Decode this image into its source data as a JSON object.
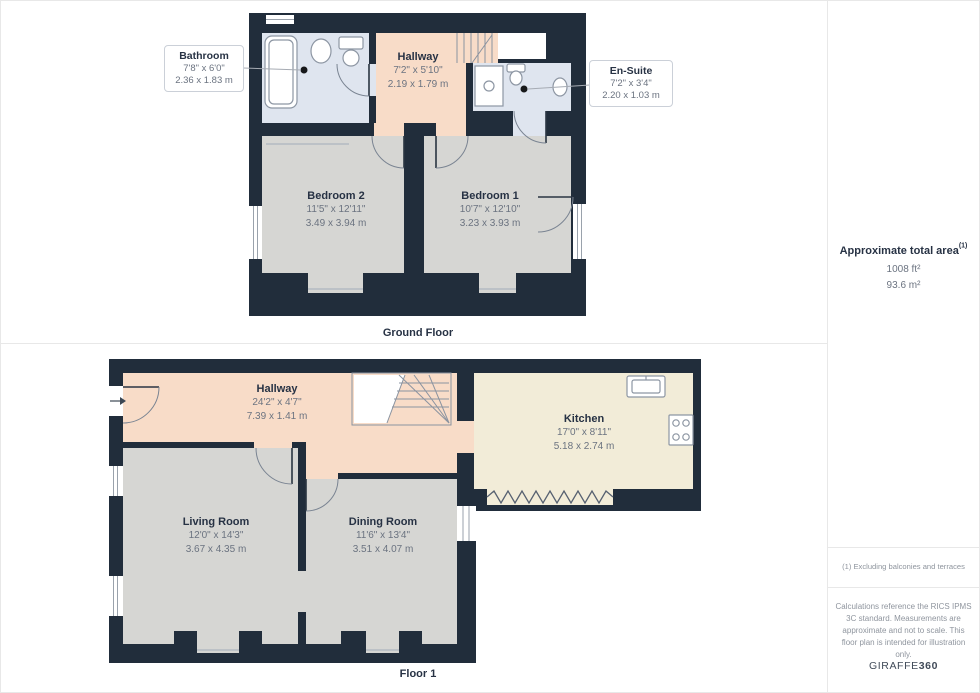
{
  "ground_floor": {
    "caption": "Ground Floor",
    "rooms": [
      {
        "name": "Bathroom",
        "imperial": "7'8\" x 6'0\"",
        "metric": "2.36 x 1.83 m"
      },
      {
        "name": "Hallway",
        "imperial": "7'2\" x 5'10\"",
        "metric": "2.19 x 1.79 m"
      },
      {
        "name": "En-Suite",
        "imperial": "7'2\" x 3'4\"",
        "metric": "2.20 x 1.03 m"
      },
      {
        "name": "Bedroom 2",
        "imperial": "11'5\" x 12'11\"",
        "metric": "3.49 x 3.94 m"
      },
      {
        "name": "Bedroom 1",
        "imperial": "10'7\" x 12'10\"",
        "metric": "3.23 x 3.93 m"
      }
    ]
  },
  "floor_1": {
    "caption": "Floor 1",
    "rooms": [
      {
        "name": "Hallway",
        "imperial": "24'2\" x 4'7\"",
        "metric": "7.39 x 1.41 m"
      },
      {
        "name": "Kitchen",
        "imperial": "17'0\" x 8'11\"",
        "metric": "5.18 x 2.74 m"
      },
      {
        "name": "Living Room",
        "imperial": "12'0\" x 14'3\"",
        "metric": "3.67 x 4.35 m"
      },
      {
        "name": "Dining Room",
        "imperial": "11'6\" x 13'4\"",
        "metric": "3.51 x 4.07 m"
      }
    ]
  },
  "sidebar": {
    "area_title": "Approximate total area",
    "area_sup": "(1)",
    "area_imperial": "1008 ft²",
    "area_metric": "93.6 m²",
    "footnote": "(1) Excluding balconies and terraces",
    "disclaimer": "Calculations reference the RICS IPMS 3C standard. Measurements are approximate and not to scale. This floor plan is intended for illustration only.",
    "brand_name": "GIRAFFE",
    "brand_suffix": "360"
  },
  "colors": {
    "wall": "#212d3b",
    "bath": "#dfe5ef",
    "hall": "#f8dcc8",
    "bed": "#d6d6d3",
    "kitchen": "#f2ecd8",
    "ink": "#273244",
    "dim": "#6b7380",
    "muted": "#8f959e",
    "border": "#e8e8e8"
  }
}
